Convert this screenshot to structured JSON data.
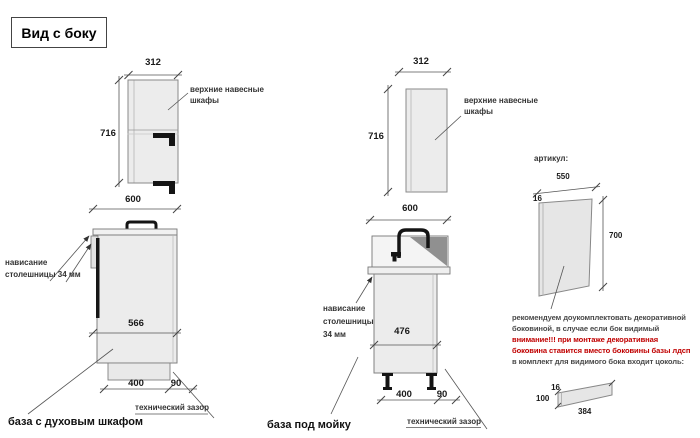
{
  "title": "Вид с боку",
  "colors": {
    "warning": "#c00000",
    "cabinet_fill": "#ececec",
    "line": "#555555"
  },
  "leftUpper": {
    "w": "312",
    "h": "716",
    "label1": "верхние навесные",
    "label2": "шкафы"
  },
  "leftBase": {
    "w": "600",
    "d": "566",
    "p": "400",
    "g": "90",
    "ov1": "нависание",
    "ov2": "столешницы 34 мм",
    "tech": "технический зазор",
    "caption": "база с духовым шкафом"
  },
  "midUpper": {
    "w": "312",
    "h": "716",
    "label1": "верхние навесные",
    "label2": "шкафы"
  },
  "midBase": {
    "w": "600",
    "d": "476",
    "p": "400",
    "g": "90",
    "ov1": "нависание",
    "ov2": "столешницы",
    "ov3": "34 мм",
    "tech": "технический зазор",
    "caption": "база под мойку"
  },
  "panel": {
    "header": "артикул:",
    "w": "550",
    "t": "16",
    "h": "700",
    "note1": "рекомендуем доукомплектовать декоративной",
    "note2": "боковиной, в случае если бок видимый",
    "warn1": "внимание!!! при монтаже декоративная",
    "warn2": "боковина ставится вместо боковины базы лдсп",
    "note3": "в комплект для видимого бока входит цоколь:"
  },
  "plinth": {
    "t": "16",
    "h": "100",
    "l": "384"
  }
}
